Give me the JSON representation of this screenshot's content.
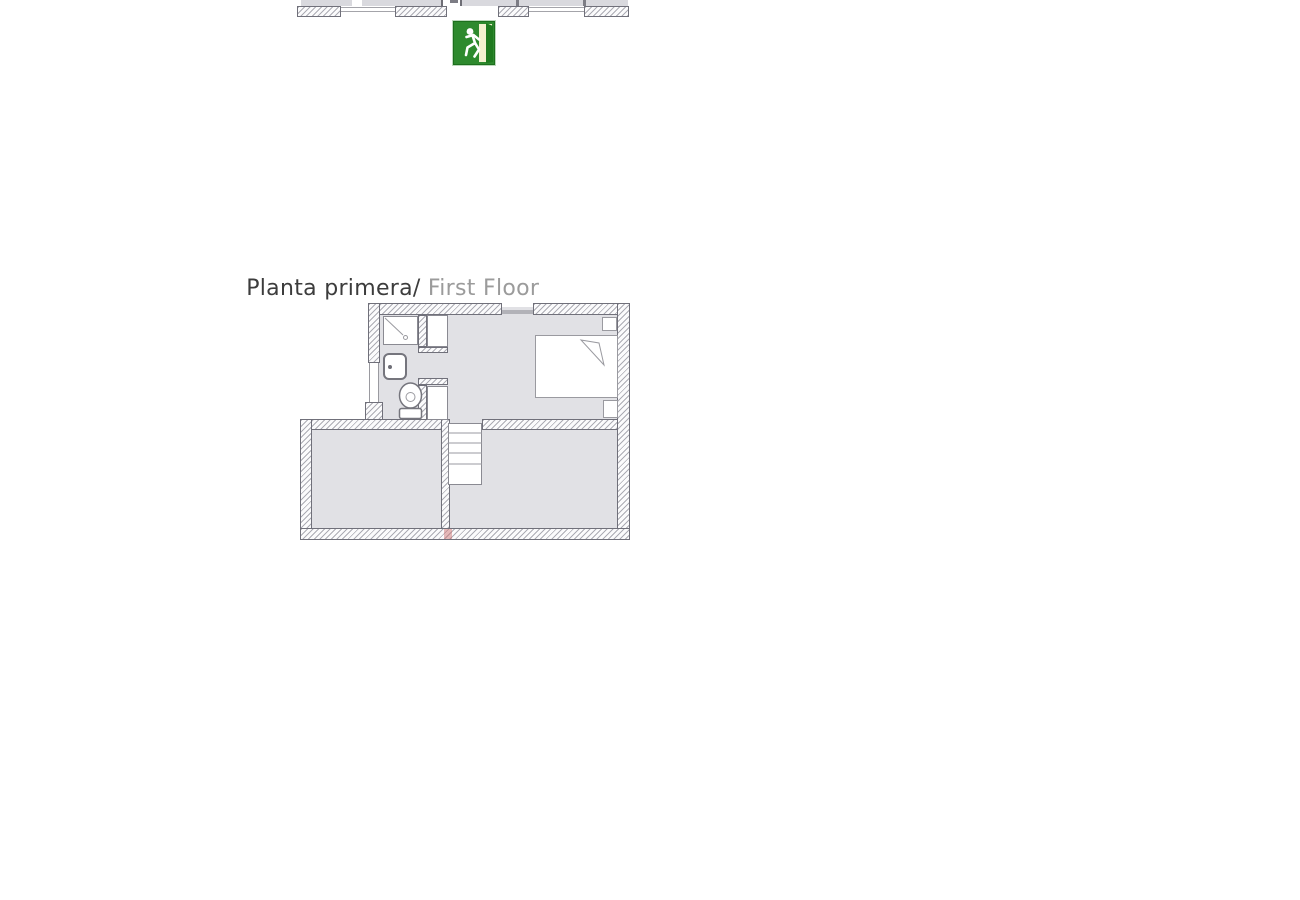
{
  "title": {
    "primary": "Planta primera/",
    "secondary": " First Floor"
  },
  "icons": {
    "exit_sign": "emergency-exit-running-man"
  },
  "colors": {
    "background": "#ffffff",
    "floor_fill": "#e1e1e5",
    "wall_outline": "#70707a",
    "hatch_line": "#78788c",
    "fixture_outline": "#9a9aa0",
    "title_primary": "#3c3c3c",
    "title_secondary": "#9b9b9b",
    "exit_sign_green": "#2e8a2e",
    "exit_sign_frame": "#1d6f1d",
    "exit_sign_door_panel": "#f3f1cf",
    "red_mark": "#c96767"
  }
}
